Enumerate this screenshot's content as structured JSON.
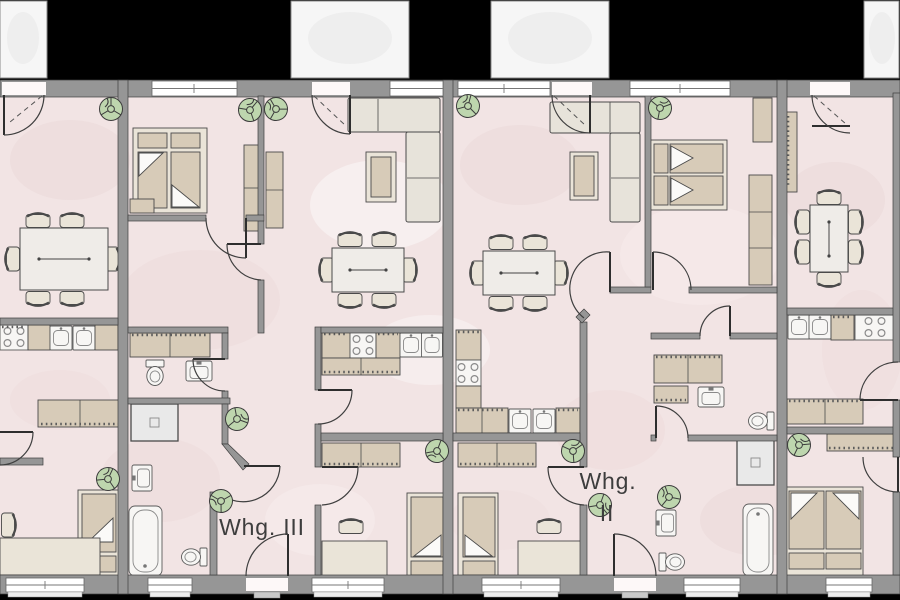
{
  "apartments": {
    "whg3": {
      "label": "Whg. III"
    },
    "whg2": {
      "line1": "Whg.",
      "line2": "II"
    }
  },
  "colors": {
    "background": "#000000",
    "floor": "#f2e4e4",
    "wall": "#969696",
    "wall_outline": "#3e3e3e",
    "balcony": "#f6f6f6",
    "furniture": "#d7cbb8",
    "furniture_light": "#eae4d8",
    "fixture": "#f7f6f4",
    "plant": "#bed6ae",
    "text": "#3d3d3d"
  }
}
